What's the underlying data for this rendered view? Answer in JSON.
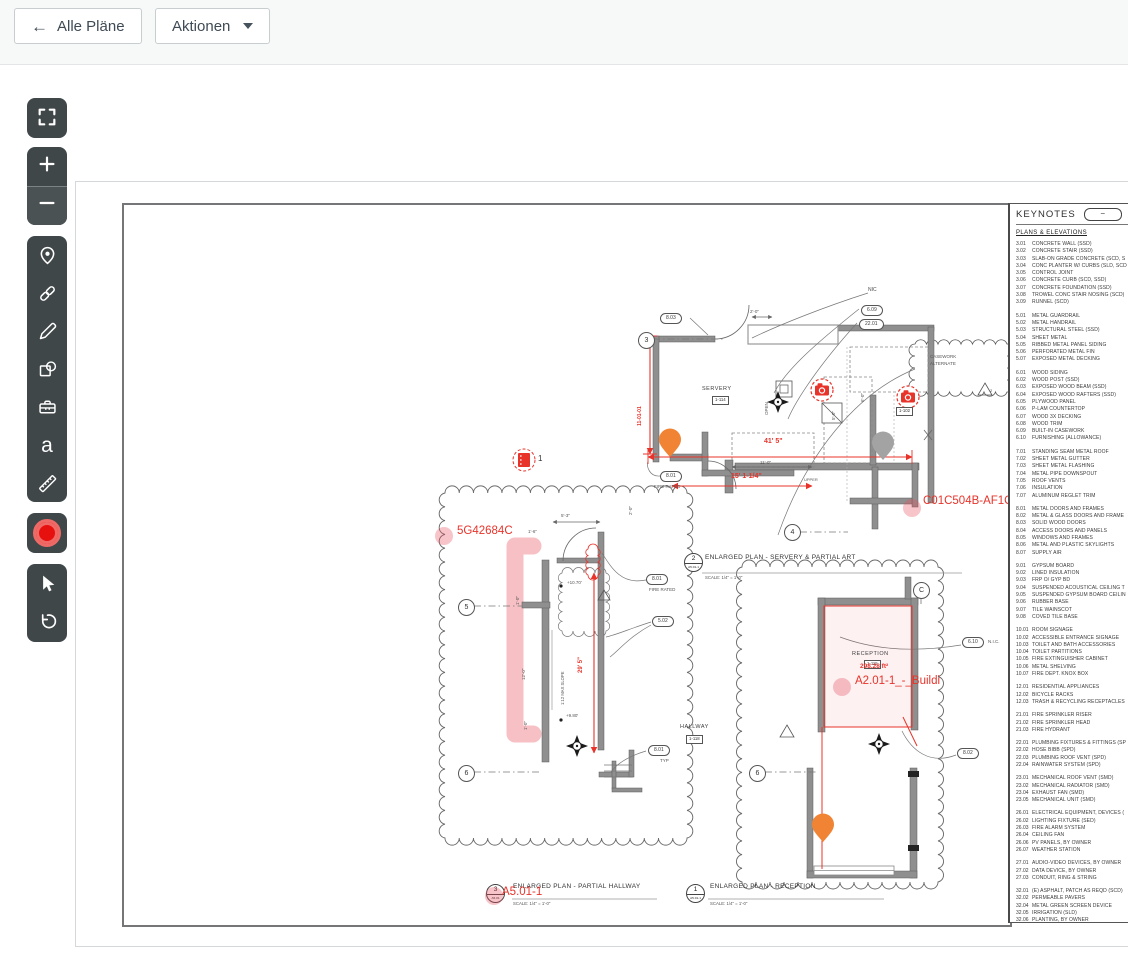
{
  "header": {
    "back_label": "Alle Pläne",
    "actions_label": "Aktionen"
  },
  "plan": {
    "notes": {
      "nic": "NIC",
      "nic_dotted": "N.I.C.",
      "casework_l1": "CASEWORK",
      "casework_l2": "ALTERNATE",
      "upper": "UPPER",
      "open": "OPEN",
      "slope": "1:12 MAX SLOPE",
      "fire_rated": "FIRE RATED",
      "typ": "TYP",
      "tri_casework": "2"
    },
    "grids": {
      "g3": "3",
      "g4": "4",
      "g5": "5",
      "g6": "6",
      "gc": "C"
    },
    "bubbles": {
      "k803": "8.03",
      "k609": "6.09",
      "k2201": "22.01",
      "k801": "8.01",
      "k502": "5.02",
      "k610": "6.10",
      "k802": "8.02"
    },
    "rooms": {
      "servery_name": "SERVERY",
      "servery_no": "1-114",
      "hallway_name": "HALLWAY",
      "hallway_no": "1-118",
      "reception_name": "RECEPTION",
      "reception_no": "1-115"
    },
    "dims": {
      "d41": "41' 5\"",
      "d15": "15' 1-1/4\"",
      "d11": "11'-0\"",
      "d29": "29' 5\"",
      "dv": "11-01-01",
      "d2": "2'-0\"",
      "d5_3": "5'-3\"",
      "d1_6": "1'-6\"",
      "d1_0": "1'-0\"",
      "d12": "12'-0\"",
      "d6": "6'-0\"",
      "d5_0": "5'-0\"",
      "e1": "+10.70'",
      "e2": "+9.80'"
    },
    "camera_tag": "1-102",
    "doc_marker": "1",
    "titles": {
      "t2": {
        "num": "2",
        "sheet": "A5.01-1",
        "title": "ENLARGED PLAN - SERVERY & PARTIAL ART",
        "scale": "SCALE: 1/4\" = 1'-0\""
      },
      "t3": {
        "num": "3",
        "sheet": "A5.01",
        "title": "ENLARGED PLAN - PARTIAL HALLWAY",
        "scale": "SCALE: 1/4\" = 1'-0\""
      },
      "t1": {
        "num": "1",
        "sheet": "A5.01-1",
        "title": "ENLARGED PLAN - RECEPTION",
        "scale": "SCALE: 1/4\" = 1'-0\""
      }
    },
    "annotations": {
      "a_hallway": "5G42684C",
      "a_servery": "C01C504B-AF1C-45",
      "a_reception": "A2.01-1_-_Buildi",
      "a_sheet": "A5.01-1",
      "area": "298.28 ft²"
    }
  },
  "keynotes": {
    "title": "KEYNOTES",
    "collapse": "−",
    "section": "PLANS & ELEVATIONS",
    "groups": [
      [
        {
          "c": "3.01",
          "t": "CONCRETE WALL (SSD)"
        },
        {
          "c": "3.02",
          "t": "CONCRETE STAIR (SSD)"
        },
        {
          "c": "3.03",
          "t": "SLAB-ON GRADE CONCRETE (SCD, S"
        },
        {
          "c": "3.04",
          "t": "CONC PLANTER W/ CURBS (SLD, SCD"
        },
        {
          "c": "3.05",
          "t": "CONTROL JOINT"
        },
        {
          "c": "3.06",
          "t": "CONCRETE CURB (SCD, SSD)"
        },
        {
          "c": "3.07",
          "t": "CONCRETE FOUNDATION (SSD)"
        },
        {
          "c": "3.08",
          "t": "TROWEL CONC STAIR NOSING (SCD)"
        },
        {
          "c": "3.09",
          "t": "RUNNEL (SCD)"
        }
      ],
      [
        {
          "c": "5.01",
          "t": "METAL GUARDRAIL"
        },
        {
          "c": "5.02",
          "t": "METAL HANDRAIL"
        },
        {
          "c": "5.03",
          "t": "STRUCTURAL STEEL (SSD)"
        },
        {
          "c": "5.04",
          "t": "SHEET METAL"
        },
        {
          "c": "5.05",
          "t": "RIBBED METAL PANEL SIDING"
        },
        {
          "c": "5.06",
          "t": "PERFORATED METAL FIN"
        },
        {
          "c": "5.07",
          "t": "EXPOSED METAL DECKING"
        }
      ],
      [
        {
          "c": "6.01",
          "t": "WOOD SIDING"
        },
        {
          "c": "6.02",
          "t": "WOOD POST (SSD)"
        },
        {
          "c": "6.03",
          "t": "EXPOSED WOOD BEAM (SSD)"
        },
        {
          "c": "6.04",
          "t": "EXPOSED WOOD RAFTERS (SSD)"
        },
        {
          "c": "6.05",
          "t": "PLYWOOD PANEL"
        },
        {
          "c": "6.06",
          "t": "P-LAM COUNTERTOP"
        },
        {
          "c": "6.07",
          "t": "WOOD 3X DECKING"
        },
        {
          "c": "6.08",
          "t": "WOOD TRIM"
        },
        {
          "c": "6.09",
          "t": "BUILT-IN CASEWORK"
        },
        {
          "c": "6.10",
          "t": "FURNISHING (ALLOWANCE)"
        }
      ],
      [
        {
          "c": "7.01",
          "t": "STANDING SEAM METAL ROOF"
        },
        {
          "c": "7.02",
          "t": "SHEET METAL GUTTER"
        },
        {
          "c": "7.03",
          "t": "SHEET METAL FLASHING"
        },
        {
          "c": "7.04",
          "t": "METAL PIPE DOWNSPOUT"
        },
        {
          "c": "7.05",
          "t": "ROOF VENTS"
        },
        {
          "c": "7.06",
          "t": "INSULATION"
        },
        {
          "c": "7.07",
          "t": "ALUMINUM REGLET TRIM"
        }
      ],
      [
        {
          "c": "8.01",
          "t": "METAL DOORS AND FRAMES"
        },
        {
          "c": "8.02",
          "t": "METAL & GLASS DOORS AND FRAME"
        },
        {
          "c": "8.03",
          "t": "SOLID WOOD DOORS"
        },
        {
          "c": "8.04",
          "t": "ACCESS DOORS AND PANELS"
        },
        {
          "c": "8.05",
          "t": "WINDOWS AND FRAMES"
        },
        {
          "c": "8.06",
          "t": "METAL AND PLASTIC SKYLIGHTS"
        },
        {
          "c": "8.07",
          "t": "SUPPLY AIR"
        }
      ],
      [
        {
          "c": "9.01",
          "t": "GYPSUM BOARD"
        },
        {
          "c": "9.02",
          "t": "LINED INSULATION"
        },
        {
          "c": "9.03",
          "t": "FRP O/ GYP BD"
        },
        {
          "c": "9.04",
          "t": "SUSPENDED ACOUSTICAL CEILING T"
        },
        {
          "c": "9.05",
          "t": "SUSPENDED GYPSUM BOARD CEILIN"
        },
        {
          "c": "9.06",
          "t": "RUBBER BASE"
        },
        {
          "c": "9.07",
          "t": "TILE WAINSCOT"
        },
        {
          "c": "9.08",
          "t": "COVED TILE BASE"
        }
      ],
      [
        {
          "c": "10.01",
          "t": "ROOM SIGNAGE"
        },
        {
          "c": "10.02",
          "t": "ACCESSIBLE ENTRANCE SIGNAGE"
        },
        {
          "c": "10.03",
          "t": "TOILET AND BATH ACCESSORIES"
        },
        {
          "c": "10.04",
          "t": "TOILET PARTITIONS"
        },
        {
          "c": "10.05",
          "t": "FIRE EXTINGUISHER CABINET"
        },
        {
          "c": "10.06",
          "t": "METAL SHELVING"
        },
        {
          "c": "10.07",
          "t": "FIRE DEPT. KNOX BOX"
        }
      ],
      [
        {
          "c": "12.01",
          "t": "RESIDENTIAL APPLIANCES"
        },
        {
          "c": "12.02",
          "t": "BICYCLE RACKS"
        },
        {
          "c": "12.03",
          "t": "TRASH & RECYCLING RECEPTACLES"
        }
      ],
      [
        {
          "c": "21.01",
          "t": "FIRE SPRINKLER RISER"
        },
        {
          "c": "21.02",
          "t": "FIRE SPRINKLER HEAD"
        },
        {
          "c": "21.03",
          "t": "FIRE HYDRANT"
        }
      ],
      [
        {
          "c": "22.01",
          "t": "PLUMBING FIXTURES & FITTINGS (SP"
        },
        {
          "c": "22.02",
          "t": "HOSE BIBB (SPD)"
        },
        {
          "c": "22.03",
          "t": "PLUMBING ROOF VENT (SPD)"
        },
        {
          "c": "22.04",
          "t": "RAINWATER SYSTEM (SPD)"
        }
      ],
      [
        {
          "c": "23.01",
          "t": "MECHANICAL ROOF VENT (SMD)"
        },
        {
          "c": "23.02",
          "t": "MECHANICAL RADIATOR (SMD)"
        },
        {
          "c": "23.04",
          "t": "EXHAUST FAN (SMD)"
        },
        {
          "c": "23.05",
          "t": "MECHANICAL UNIT (SMD)"
        }
      ],
      [
        {
          "c": "26.01",
          "t": "ELECTRICAL EQUIPMENT, DEVICES ("
        },
        {
          "c": "26.02",
          "t": "LIGHTING FIXTURE (SED)"
        },
        {
          "c": "26.03",
          "t": "FIRE ALARM SYSTEM"
        },
        {
          "c": "26.04",
          "t": "CEILING FAN"
        },
        {
          "c": "26.06",
          "t": "PV PANELS, BY OWNER"
        },
        {
          "c": "26.07",
          "t": "WEATHER STATION"
        }
      ],
      [
        {
          "c": "27.01",
          "t": "AUDIO-VIDEO DEVICES, BY OWNER"
        },
        {
          "c": "27.02",
          "t": "DATA DEVICE, BY OWNER"
        },
        {
          "c": "27.03",
          "t": "CONDUIT, RING & STRING"
        }
      ],
      [
        {
          "c": "32.01",
          "t": "(E) ASPHALT, PATCH AS REQD (SCD)"
        },
        {
          "c": "32.02",
          "t": "PERMEABLE PAVERS"
        },
        {
          "c": "32.04",
          "t": "METAL GREEN SCREEN DEVICE"
        },
        {
          "c": "32.05",
          "t": "IRRIGATION (SLD)"
        },
        {
          "c": "32.06",
          "t": "PLANTING, BY OWNER"
        },
        {
          "c": "32.07",
          "t": "METAL FENCING & GATE"
        },
        {
          "c": "32.08",
          "t": "DECOMPOSED GRANITE (SLD)"
        },
        {
          "c": "32.09",
          "t": "PAVEMENT STRIPING, BY OWNER"
        },
        {
          "c": "32.10",
          "t": "BIOSWALE (SLD, SCD)"
        }
      ],
      [
        {
          "c": "33.01",
          "t": "FOUNDATION DRAINAGE"
        },
        {
          "c": "33.02",
          "t": "STORM DRAIN (SCD), BY OWNER"
        }
      ]
    ]
  }
}
